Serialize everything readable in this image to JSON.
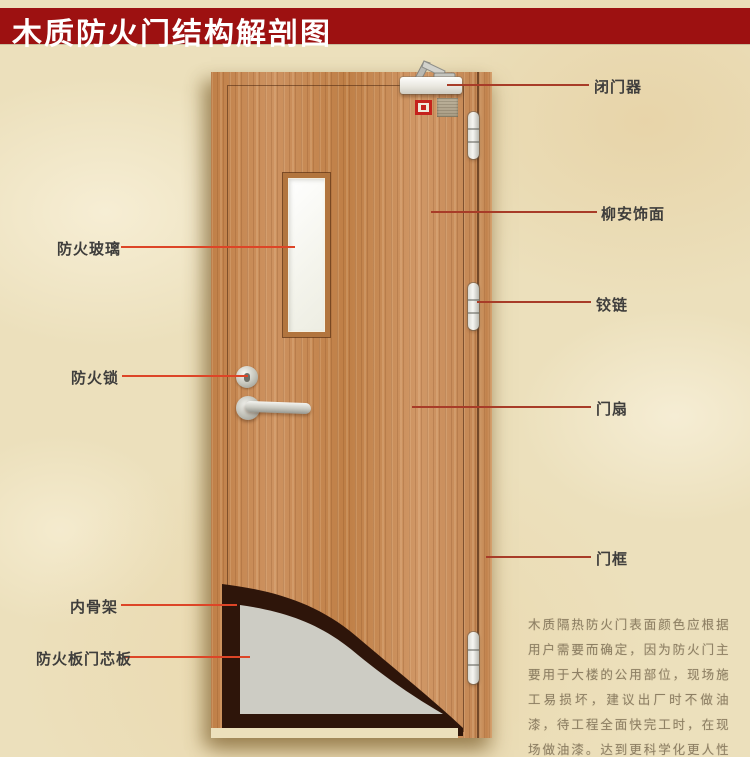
{
  "banner": {
    "title": "木质防火门结构解剖图"
  },
  "theme": {
    "paper_bg": "#ece0bc",
    "banner_bg": "#9d1111",
    "banner_text": "#ffffff",
    "left_line_color": "#dd4527",
    "right_line_color": "#a83c28",
    "indicator_red": "#c5221c",
    "wood_base": "#c68a55",
    "core_gray": "#cdccc4",
    "skeleton_dark": "#2e150a"
  },
  "annotations": {
    "left": [
      {
        "id": "fire-glass",
        "text": "防火玻璃"
      },
      {
        "id": "fire-lock",
        "text": "防火锁"
      },
      {
        "id": "inner-skeleton",
        "text": "内骨架"
      },
      {
        "id": "core-panel",
        "text": "防火板门芯板"
      }
    ],
    "right": [
      {
        "id": "door-closer",
        "text": "闭门器"
      },
      {
        "id": "lauan-veneer",
        "text": "柳安饰面"
      },
      {
        "id": "hinge",
        "text": "铰链"
      },
      {
        "id": "door-leaf",
        "text": "门扇"
      },
      {
        "id": "door-frame",
        "text": "门框"
      }
    ]
  },
  "description": {
    "text": "木质隔热防火门表面颜色应根据用户需要而确定，因为防火门主要用于大楼的公用部位，现场施工易损坏，建议出厂时不做油漆，待工程全面快完工时，在现场做油漆。达到更科学化更人性化的服务。"
  }
}
